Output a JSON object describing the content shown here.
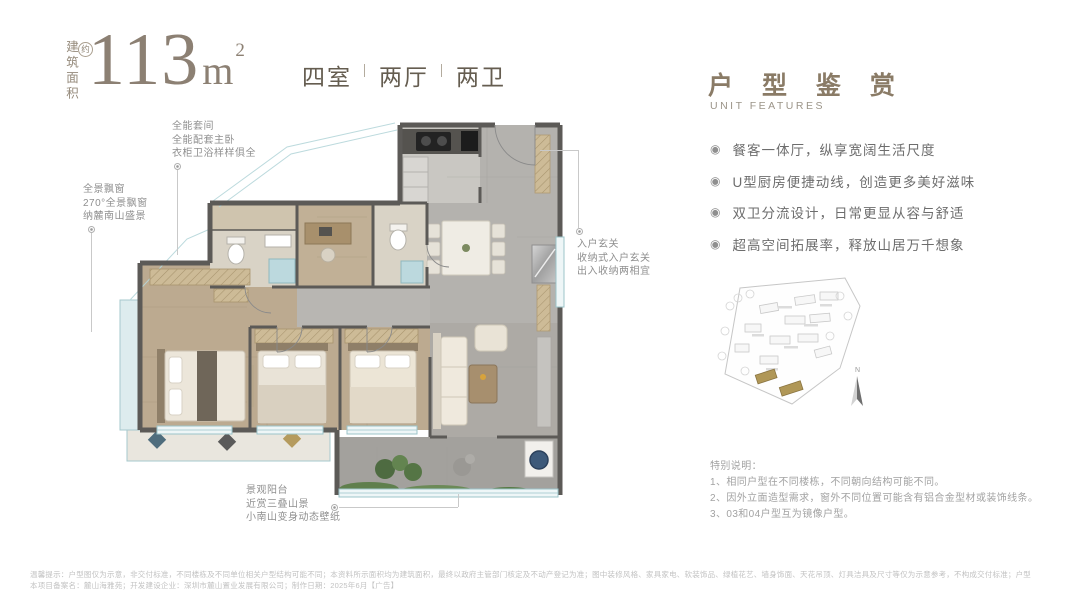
{
  "header": {
    "area_prefix_vertical": "建筑面积",
    "approx_badge": "约",
    "area_number": "113",
    "area_unit": "m",
    "area_sup": "2",
    "spec": {
      "rooms": "四室",
      "halls": "两厅",
      "baths": "两卫"
    }
  },
  "plan": {
    "annotations": {
      "suite": {
        "lines": [
          "全能套间",
          "全能配套主卧",
          "衣柜卫浴样样俱全"
        ]
      },
      "bay": {
        "lines": [
          "全景飘窗",
          "270°全景飘窗",
          "纳麓南山盛景"
        ]
      },
      "entrance": {
        "lines": [
          "入户玄关",
          "收纳式入户玄关",
          "出入收纳两相宜"
        ]
      },
      "balcony": {
        "lines": [
          "景观阳台",
          "近赏三叠山景",
          "小南山变身动态壁纸"
        ]
      }
    }
  },
  "right_panel": {
    "title": "户 型 鉴 赏",
    "subtitle": "UNIT FEATURES",
    "features": [
      "餐客一体厅，纵享宽阔生活尺度",
      "U型厨房便捷动线，创造更多美好滋味",
      "双卫分流设计，日常更显从容与舒适",
      "超高空间拓展率，释放山居万千想象"
    ],
    "compass": "N",
    "notes_title": "特别说明：",
    "notes": [
      "1、相同户型在不同楼栋，不同朝向结构可能不同。",
      "2、因外立面造型需求，窗外不同位置可能含有铝合金型材或装饰线条。",
      "3、03和04户型互为镜像户型。"
    ]
  },
  "footer": {
    "line1": "温馨提示：户型图仅为示意，非交付标准，不同楼栋及不同单位相关户型结构可能不同；本资料所示面积均为建筑面积，最终以政府主管部门核定及不动产登记为准；图中装修风格、家具家电、软装饰品、绿植花艺、墙身饰面、天花吊顶、灯具洁具及尺寸等仅为示意参考，不构成交付标准；户型",
    "line2": "本项目备案名：麓山海雅苑；开发建设企业：深圳市麓山置业发展有限公司；制作日期：2025年6月【广告】"
  },
  "colors": {
    "accent": "#8c8073",
    "wall": "#5c5a57",
    "wood_floor": "#bcaa90",
    "tile_floor": "#b0aeab",
    "glass": "#9cc4ca",
    "highlight_building": "#b09757"
  }
}
